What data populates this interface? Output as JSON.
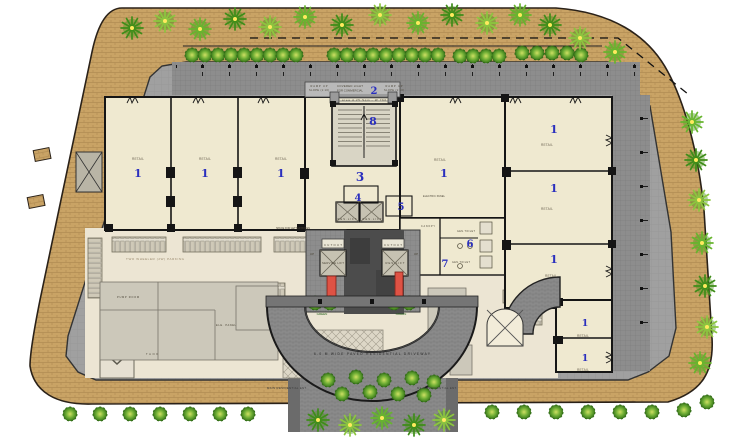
{
  "colors": {
    "accent_blue": "#2a2fbe",
    "site_tan": "#c9a365",
    "plaza_gray": "#a0a0a0",
    "walk_gray": "#8d8d8d",
    "room_cream": "#efe9d0",
    "floor_pale": "#ece5d3",
    "utility_gray": "#ccc8ba",
    "core_dark": "#4c4c4c",
    "accent_red": "#df5244",
    "leaf_green": "#5fa42d",
    "wall_black": "#151515"
  },
  "plan": {
    "unit_numbers": {
      "retail": "1",
      "light_well": "2",
      "lobby": "3",
      "stair_room": "4",
      "panel_room": "5",
      "toilet_a": "6",
      "toilet_b": "7",
      "entrance_steps": "8"
    },
    "labels": {
      "retail": "RETAIL",
      "res_lift": "RES.LIFT",
      "service_lift": "SERVICE LIFT",
      "cutout": "CUTOUT",
      "up": "UP",
      "green": "GREEN",
      "letter_boxes": "SPACE FOR LETTER BOXES",
      "gen_toilet": "GEN.TOILET",
      "ramp_up": "RAMP UP",
      "ramp_slope": "SLOPE (1:10)",
      "covered_light_1": "COVERED LIGHT",
      "covered_light_2": "FOR COMMERCIAL",
      "entrance_steps": "area 4.25 Sqm - W 760",
      "two_wheeler_parking": "TWO WHEELER (2W) PARKING",
      "driveway": "6.0 M WIDE PAVED RESIDENTIAL DRIVEWAY",
      "main_ent": "MAIN RESIDENTIAL ENT.",
      "pump_room": "PUMP ROOM",
      "ele_panel": "ELE. PANEL",
      "tank": "TANK",
      "electric_panel": "ELECTRIC PANEL",
      "canopy": "CANOPY"
    }
  }
}
